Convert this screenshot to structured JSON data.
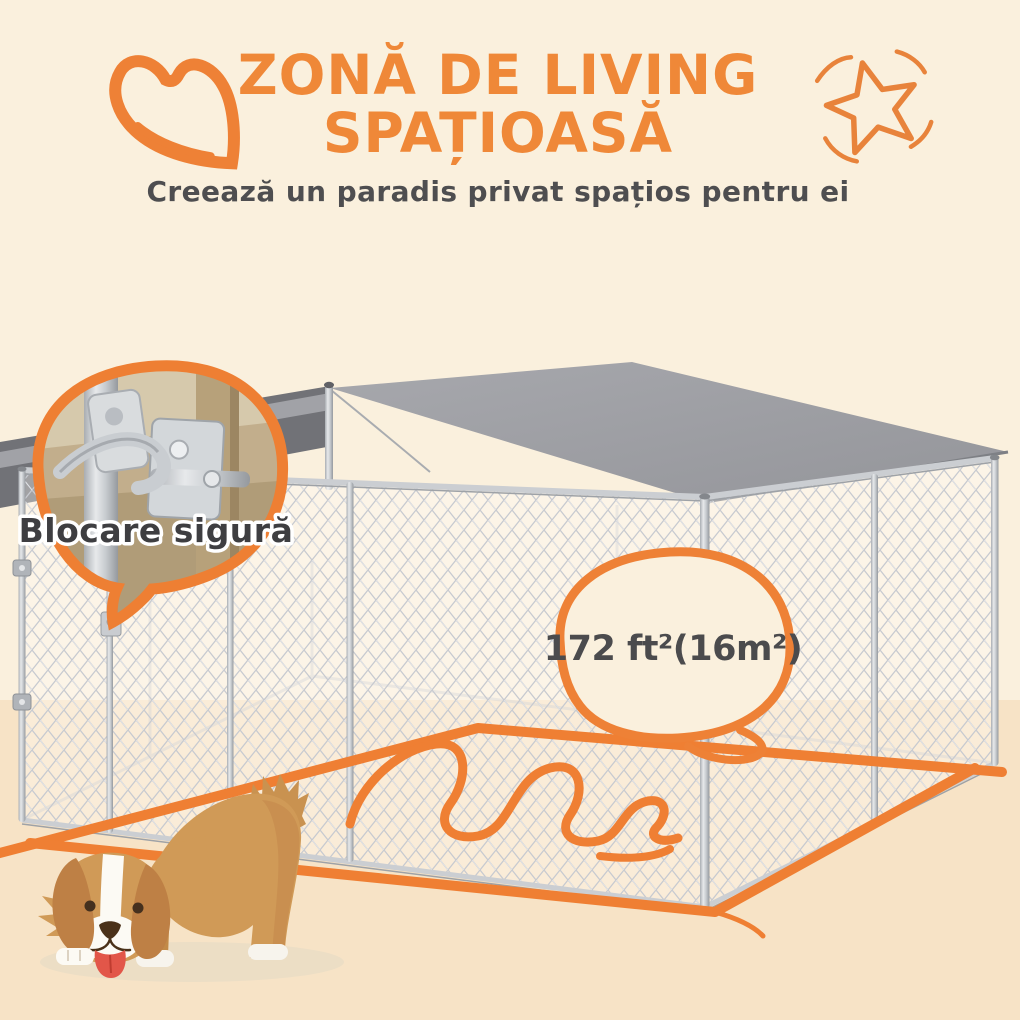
{
  "header": {
    "title_line1": "ZONĂ DE LIVING",
    "title_line2": "SPAȚIOASĂ",
    "subtitle": "Creează un paradis privat spațios pentru ei"
  },
  "callouts": {
    "lock_label": "Blocare sigură",
    "area_label": "172 ft²(16m²)"
  },
  "scene": {
    "product": "outdoor-dog-kennel-with-gray-canopy",
    "mascot": "brown-puppy-play-bow",
    "floor_highlight": "orange-hand-drawn-area-outline"
  },
  "colors": {
    "accent_orange": "#EF8136",
    "title_orange": "#EF8838",
    "background_cream": "#FAF0DD",
    "ground_cream": "#F7E3C6",
    "canopy_gray": "#9C9EA3",
    "canopy_dark_gray": "#717277",
    "text_dark_gray": "#4B4B4D"
  }
}
